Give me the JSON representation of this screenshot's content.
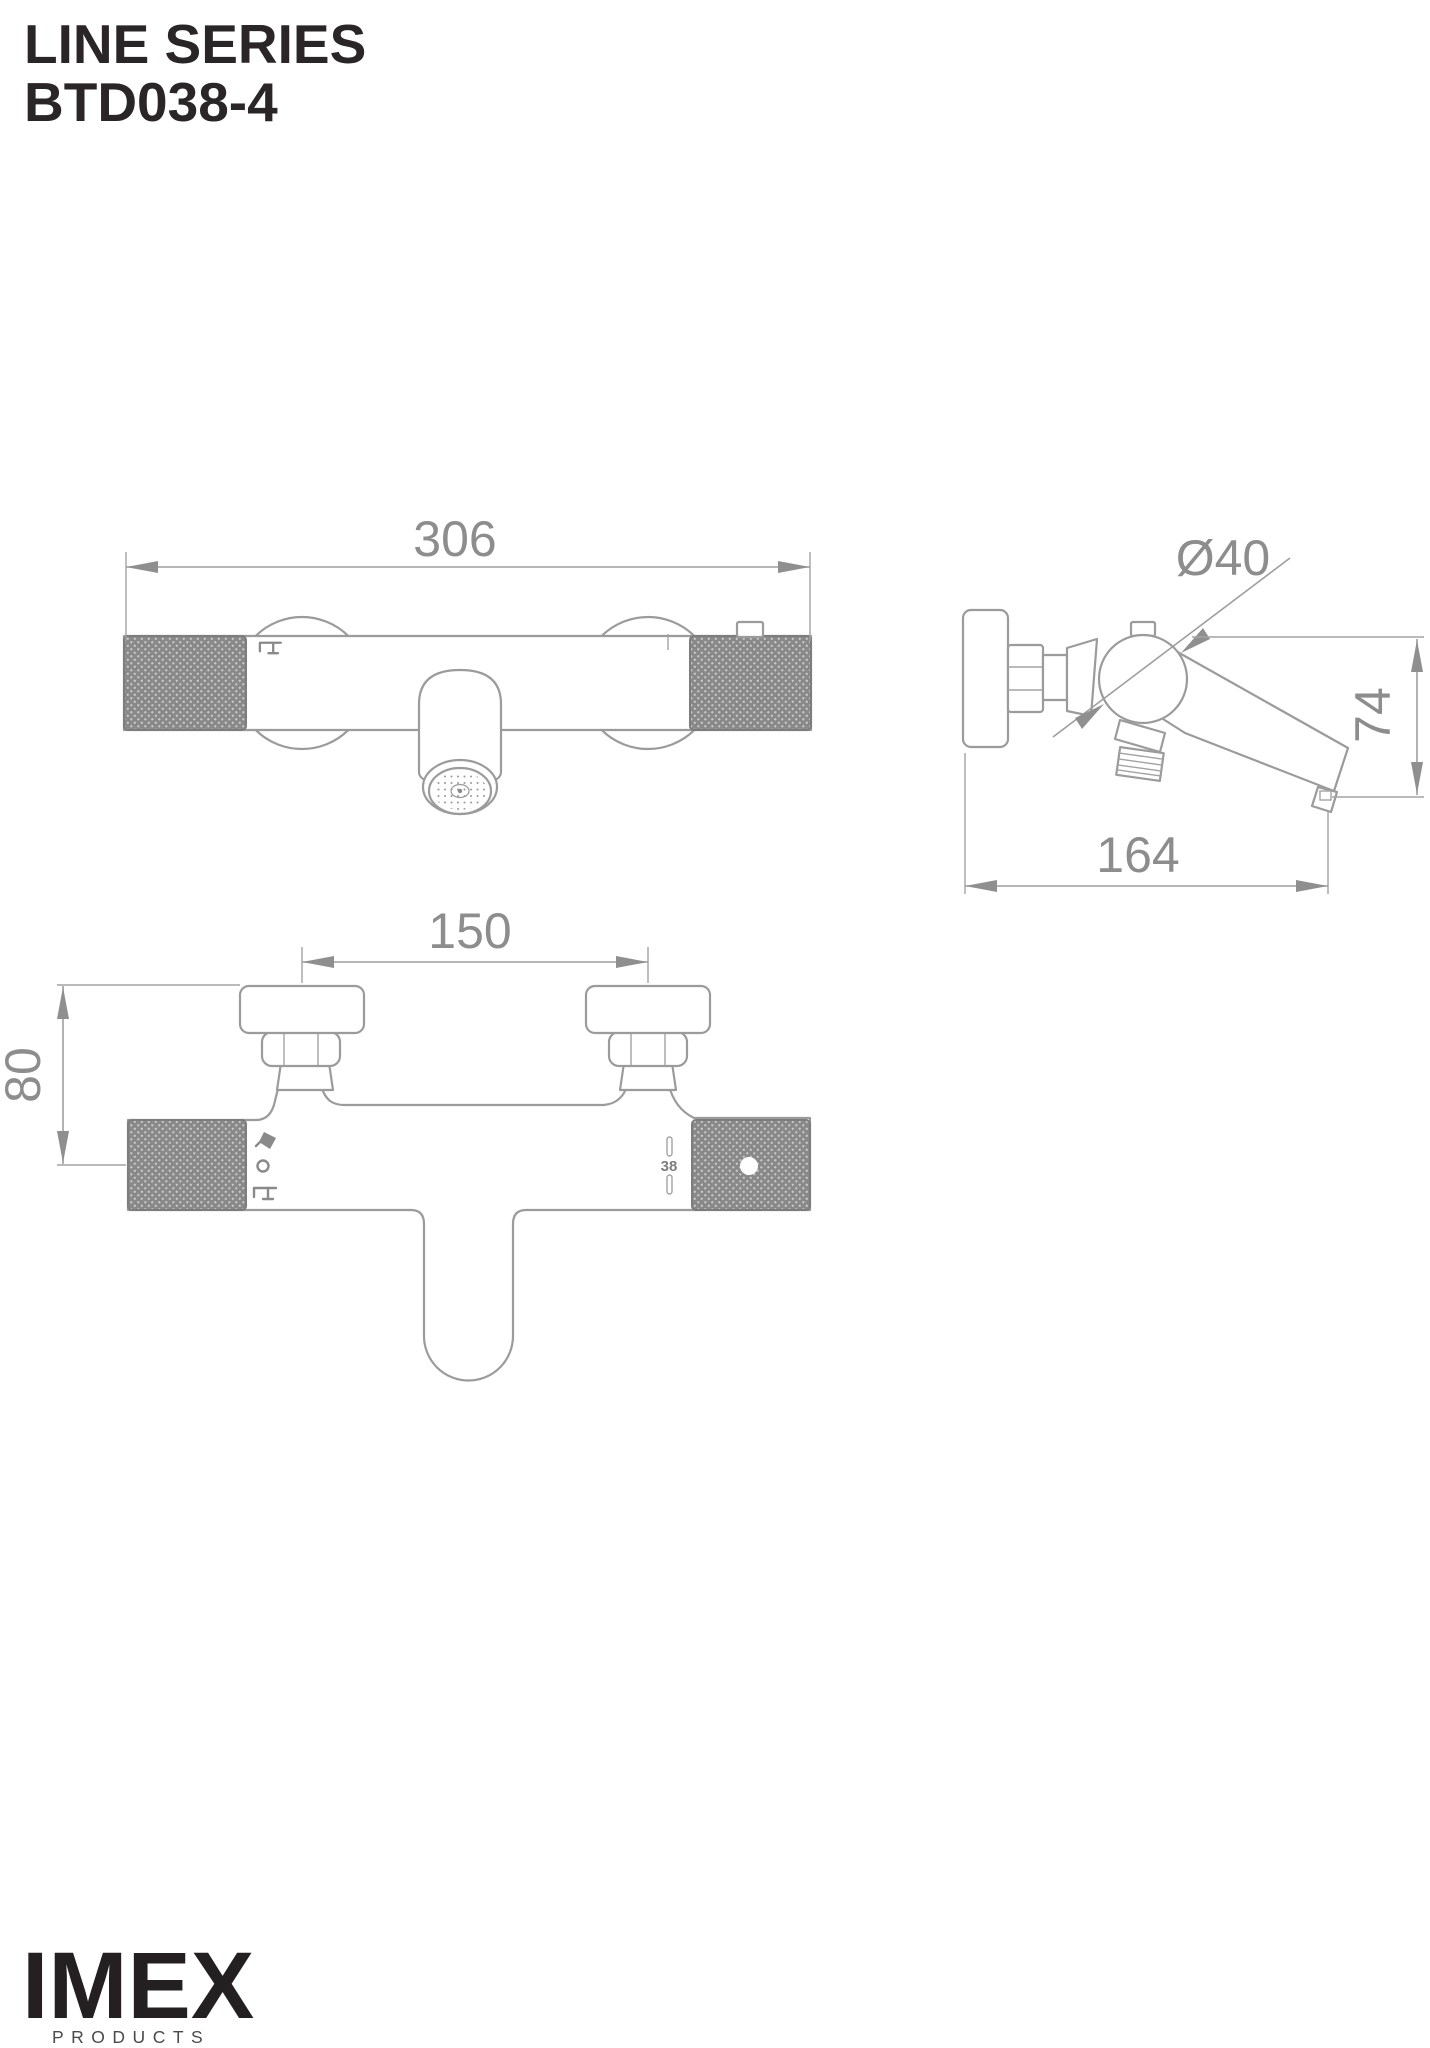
{
  "title": {
    "series": "LINE SERIES",
    "model": "BTD038-4"
  },
  "logo": {
    "brand": "IMEX",
    "tagline": "PRODUCTS"
  },
  "dimensions": {
    "front_width": "306",
    "side_diameter": "Ø40",
    "side_height": "74",
    "side_depth": "164",
    "plan_spacing": "150",
    "plan_depth": "80",
    "temp_stop": "38"
  },
  "icons": {
    "front_body": "tap-icon",
    "plan_diverter_top": "hand-shower-icon",
    "plan_diverter_mid": "dot-position-icon",
    "plan_diverter_bottom": "tap-icon"
  },
  "colors": {
    "drawing_line": "#9b9b9b",
    "dimension_text": "#8d8d8d",
    "knurl_fill": "#898989",
    "title_text": "#2a2527",
    "logo_text": "#242021"
  }
}
